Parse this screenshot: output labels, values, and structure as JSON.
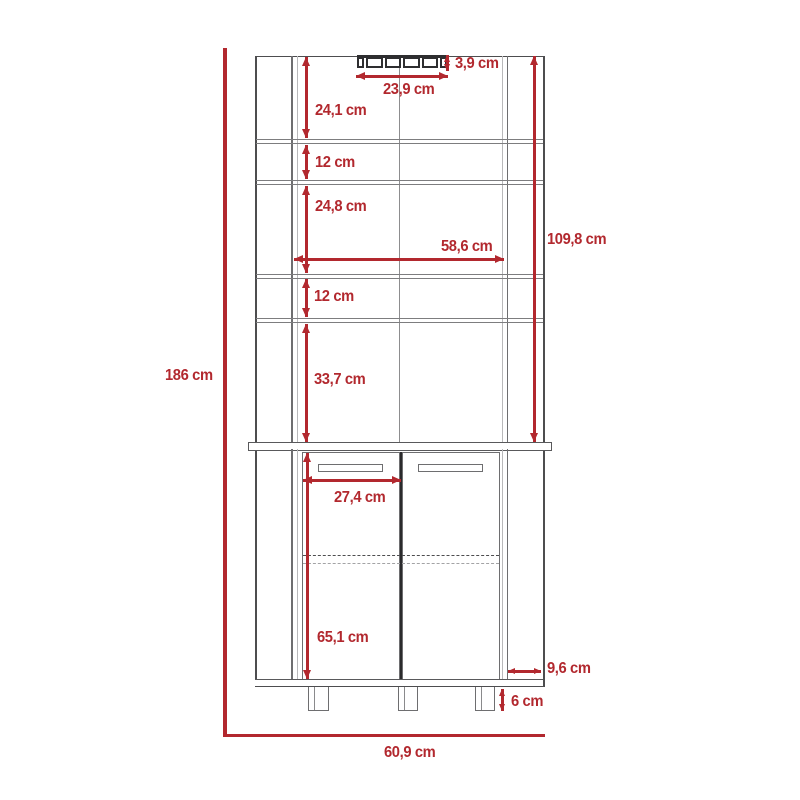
{
  "diagram": {
    "type": "furniture-dimension-drawing",
    "subject": "corner bar cabinet with shelves, bottle rack and two doors",
    "unit": "cm",
    "colors": {
      "dimension_red": "#b2282e",
      "outline_gray": "#4d4d4f",
      "light_gray": "#b9b9bb",
      "dark_line": "#2a2a2c"
    },
    "dimensions": {
      "overall_height": "186 cm",
      "overall_width": "60,9 cm",
      "upper_cavity_height": "109,8 cm",
      "interior_width": "58,6 cm",
      "bottle_rack_height": "3,9 cm",
      "bottle_rack_width": "23,9 cm",
      "top_section_height": "24,1 cm",
      "second_section_height": "12 cm",
      "third_section_height": "24,8 cm",
      "fourth_section_height": "12 cm",
      "fifth_section_height": "33,7 cm",
      "door_width": "27,4 cm",
      "lower_cabinet_height": "65,1 cm",
      "side_panel_depth": "9,6 cm",
      "leg_height": "6 cm"
    }
  }
}
